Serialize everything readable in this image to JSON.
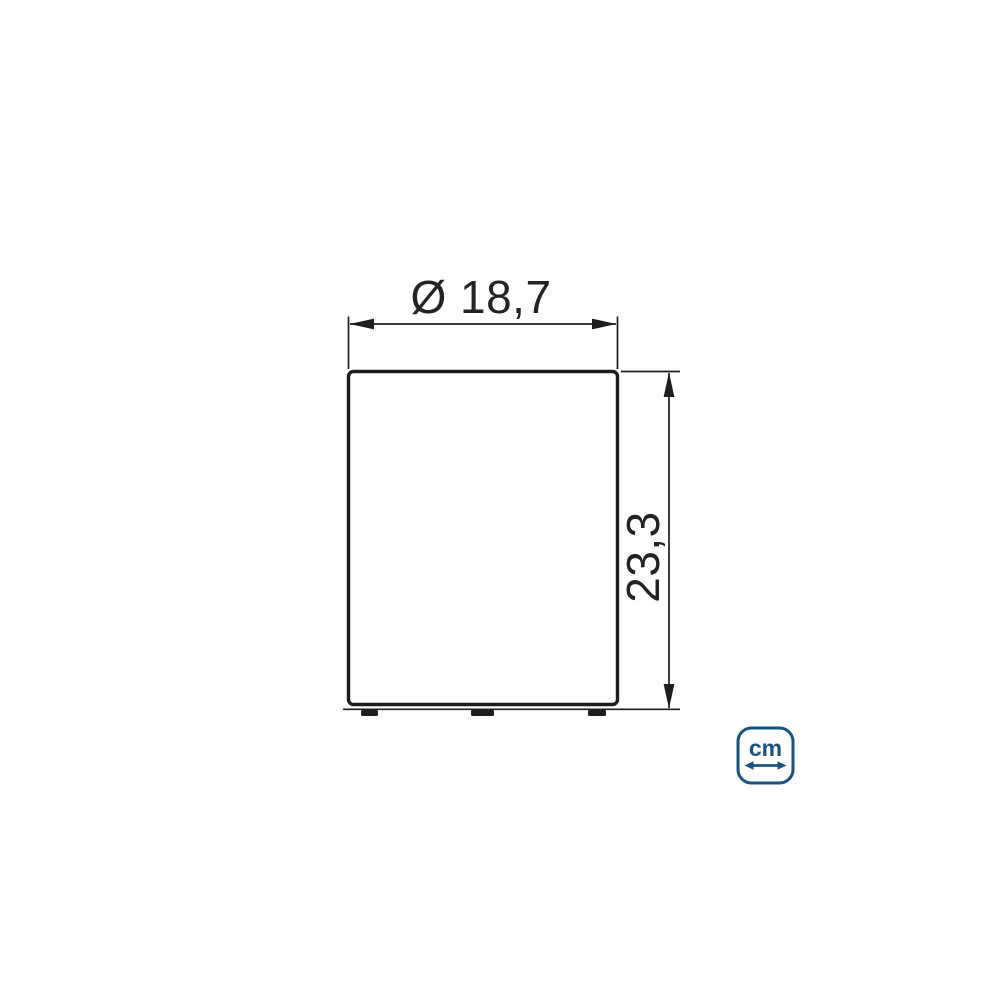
{
  "diagram": {
    "width_label": "Ø 18,7",
    "height_label": "23,3"
  },
  "unit_badge": {
    "label": "cm"
  },
  "colors": {
    "line_black": "#1d1d1b",
    "dimension_text": "#232323",
    "badge_blue": "#1a5280",
    "background": "#ffffff"
  }
}
